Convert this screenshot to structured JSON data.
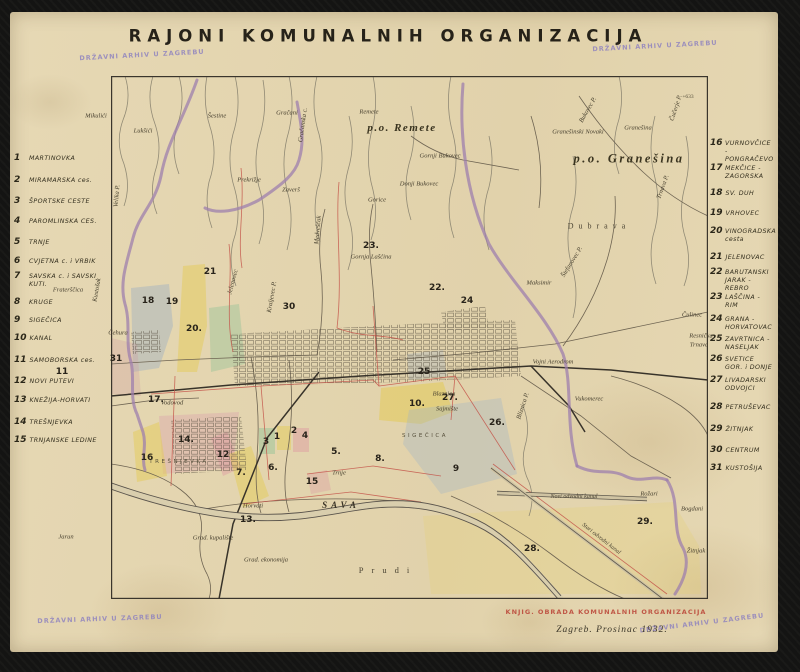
{
  "palette": {
    "paper": "#e6d8b4",
    "ink": "#2b2719",
    "purple_boundary": "#9d7fae",
    "red_boundary": "#c4554a",
    "stamp_purple": "#8b7fc0",
    "stamp_red": "#b8392e",
    "river": "#5a544c",
    "yellow_district": "#e4cb58",
    "green_district": "#98c498",
    "blue_district": "#94aac4",
    "rose_district": "#da a2ac"
  },
  "title": "RAJONI KOMUNALNIH ORGANIZACIJA",
  "stamp_text": "DRŽAVNI ARHIV U ZAGREBU",
  "footer": {
    "red_stamp": "KNJIG. OBRADA KOMUNALNIH ORGANIZACIJA",
    "date": "Zagreb. Prosinac 1932."
  },
  "left_list": [
    {
      "num": "1",
      "label": "MARTINOVKA",
      "y": 158
    },
    {
      "num": "2",
      "label": "MIRAMARSKA ces.",
      "y": 180
    },
    {
      "num": "3",
      "label": "ŠPORTSKE CESTE",
      "y": 201
    },
    {
      "num": "4",
      "label": "PAROMLINSKA CES.",
      "y": 221
    },
    {
      "num": "5",
      "label": "TRNJE",
      "y": 242
    },
    {
      "num": "6",
      "label": "CVJETNA c. i VRBIK",
      "y": 261
    },
    {
      "num": "7",
      "label": "SAVSKA c. i SAVSKI KUTI.",
      "y": 280
    },
    {
      "num": "8",
      "label": "KRUGE",
      "y": 302
    },
    {
      "num": "9",
      "label": "SIGEČICA",
      "y": 320
    },
    {
      "num": "10",
      "label": "KANAL",
      "y": 338
    },
    {
      "num": "11",
      "label": "SAMOBORSKA ces.",
      "y": 360
    },
    {
      "num": "12",
      "label": "NOVI PUTEVI",
      "y": 381
    },
    {
      "num": "13",
      "label": "KNEŽIJA-HORVATI",
      "y": 400
    },
    {
      "num": "14",
      "label": "TREŠNJEVKA",
      "y": 422
    },
    {
      "num": "15",
      "label": "TRNJANSKE LEDINE",
      "y": 440
    }
  ],
  "right_list": [
    {
      "num": "16",
      "label": "VURNOVČICE - PONGRAČEVO",
      "y": 151
    },
    {
      "num": "17",
      "label": "MEKČICE - ZAGORSKA",
      "y": 172
    },
    {
      "num": "18",
      "label": "SV. DUH",
      "y": 193
    },
    {
      "num": "19",
      "label": "VRHOVEC",
      "y": 213
    },
    {
      "num": "20",
      "label": "VINOGRADSKA cesta",
      "y": 235
    },
    {
      "num": "21",
      "label": "JELENOVAC",
      "y": 257
    },
    {
      "num": "22",
      "label": "BARUTANSKI JARAK - REBRO",
      "y": 280
    },
    {
      "num": "23",
      "label": "LAŠČINA - RIM",
      "y": 301
    },
    {
      "num": "24",
      "label": "GRANA - HORVATOVAC",
      "y": 323
    },
    {
      "num": "25",
      "label": "ZAVRTNICA - NASELJAK",
      "y": 343
    },
    {
      "num": "26",
      "label": "SVETICE GOR. i DONJE",
      "y": 363
    },
    {
      "num": "27",
      "label": "LIVADARSKI ODVOJCI",
      "y": 384
    },
    {
      "num": "28",
      "label": "PETRUŠEVAC",
      "y": 407
    },
    {
      "num": "29",
      "label": "ŽITNJAK",
      "y": 429
    },
    {
      "num": "30",
      "label": "CENTRUM",
      "y": 450
    },
    {
      "num": "31",
      "label": "KUSTOŠIJA",
      "y": 468
    }
  ],
  "map": {
    "labels": [
      {
        "t": "Mikulići",
        "x": 96,
        "y": 116
      },
      {
        "t": "Lukšići",
        "x": 143,
        "y": 131
      },
      {
        "t": "Šestine",
        "x": 217,
        "y": 116
      },
      {
        "t": "Gračani",
        "x": 287,
        "y": 113
      },
      {
        "t": "Remete",
        "x": 369,
        "y": 112
      },
      {
        "t": "p.o. Remete",
        "x": 402,
        "y": 128,
        "cls": "big"
      },
      {
        "t": "Gornji Bukovec",
        "x": 440,
        "y": 156
      },
      {
        "t": "Donji Bukovec",
        "x": 419,
        "y": 184
      },
      {
        "t": "Granešinski Novaki",
        "x": 578,
        "y": 132
      },
      {
        "t": "Granešina",
        "x": 638,
        "y": 128
      },
      {
        "t": "p.o. Granešina",
        "x": 629,
        "y": 159,
        "cls": "big2"
      },
      {
        "t": "Dubrava",
        "x": 599,
        "y": 226,
        "cls": "sp"
      },
      {
        "t": "Prekrižje",
        "x": 249,
        "y": 180
      },
      {
        "t": "Zaverš",
        "x": 291,
        "y": 190
      },
      {
        "t": "Gorice",
        "x": 377,
        "y": 200
      },
      {
        "t": "Gornja Lašćina",
        "x": 371,
        "y": 257
      },
      {
        "t": "Maksimir",
        "x": 539,
        "y": 283
      },
      {
        "t": "Vojni Aerodrom",
        "x": 553,
        "y": 362
      },
      {
        "t": "Vukomerec",
        "x": 589,
        "y": 399
      },
      {
        "t": "Čulinec",
        "x": 692,
        "y": 315
      },
      {
        "t": "Resnička",
        "x": 701,
        "y": 336
      },
      {
        "t": "Trnava",
        "x": 699,
        "y": 345
      },
      {
        "t": "Fraterščica",
        "x": 68,
        "y": 290
      },
      {
        "t": "Čehura",
        "x": 118,
        "y": 333
      },
      {
        "t": "Horvati",
        "x": 253,
        "y": 506
      },
      {
        "t": "Jarun",
        "x": 66,
        "y": 537
      },
      {
        "t": "Grad. kupalište",
        "x": 213,
        "y": 538
      },
      {
        "t": "Grad. ekonomija",
        "x": 266,
        "y": 560
      },
      {
        "t": "Rožari",
        "x": 649,
        "y": 494
      },
      {
        "t": "Bogdani",
        "x": 692,
        "y": 509
      },
      {
        "t": "Žitnjak",
        "x": 696,
        "y": 551
      },
      {
        "t": "Blaznica",
        "x": 444,
        "y": 394
      },
      {
        "t": "Sajmište",
        "x": 447,
        "y": 409
      },
      {
        "t": "Trnje",
        "x": 339,
        "y": 473
      },
      {
        "t": "Vodovod",
        "x": 172,
        "y": 403
      },
      {
        "t": "Novi odvodni kanal",
        "x": 574,
        "y": 497,
        "cls": "si"
      },
      {
        "t": "Stari odvodni kanal",
        "x": 601,
        "y": 539,
        "r": 38,
        "cls": "si"
      },
      {
        "t": "Velika P.",
        "x": 117,
        "y": 196,
        "r": -85
      },
      {
        "t": "Kustošak",
        "x": 97,
        "y": 290,
        "r": -80
      },
      {
        "t": "Jelenovec",
        "x": 233,
        "y": 282,
        "r": -75
      },
      {
        "t": "Kraljevec P.",
        "x": 272,
        "y": 297,
        "r": -80
      },
      {
        "t": "Medveščak",
        "x": 318,
        "y": 230,
        "r": -85
      },
      {
        "t": "Gračanska c.",
        "x": 303,
        "y": 125,
        "r": -82
      },
      {
        "t": "Bliznica P.",
        "x": 523,
        "y": 406,
        "r": -72
      },
      {
        "t": "Štefanovec P.",
        "x": 572,
        "y": 262,
        "r": -58
      },
      {
        "t": "Trnava P.",
        "x": 663,
        "y": 187,
        "r": -70
      },
      {
        "t": "Bukovec P.",
        "x": 588,
        "y": 110,
        "r": -60
      },
      {
        "t": "Čučerje P.",
        "x": 676,
        "y": 108,
        "r": -72
      },
      {
        "t": "TREŠNJEVKA",
        "x": 179,
        "y": 462,
        "cls": "spx"
      },
      {
        "t": "SIGEČICA",
        "x": 425,
        "y": 436,
        "cls": "spx"
      },
      {
        "t": "SAVA",
        "x": 341,
        "y": 505,
        "cls": "sava"
      },
      {
        "t": "Prudi",
        "x": 388,
        "y": 570,
        "cls": "sp2"
      },
      {
        "t": "+633",
        "x": 688,
        "y": 97,
        "cls": "tiny"
      }
    ],
    "numbers": [
      {
        "n": "1",
        "x": 277,
        "y": 437
      },
      {
        "n": "2",
        "x": 294,
        "y": 431
      },
      {
        "n": "3",
        "x": 266,
        "y": 442
      },
      {
        "n": "4",
        "x": 305,
        "y": 436
      },
      {
        "n": "5.",
        "x": 336,
        "y": 452
      },
      {
        "n": "6.",
        "x": 273,
        "y": 468
      },
      {
        "n": "7.",
        "x": 241,
        "y": 473
      },
      {
        "n": "8.",
        "x": 380,
        "y": 459
      },
      {
        "n": "9",
        "x": 456,
        "y": 469
      },
      {
        "n": "10.",
        "x": 417,
        "y": 404
      },
      {
        "n": "11",
        "x": 62,
        "y": 372
      },
      {
        "n": "12",
        "x": 223,
        "y": 455
      },
      {
        "n": "13.",
        "x": 248,
        "y": 520
      },
      {
        "n": "14.",
        "x": 186,
        "y": 440
      },
      {
        "n": "15",
        "x": 312,
        "y": 482
      },
      {
        "n": "16",
        "x": 147,
        "y": 458
      },
      {
        "n": "17.",
        "x": 156,
        "y": 400
      },
      {
        "n": "18",
        "x": 148,
        "y": 301
      },
      {
        "n": "19",
        "x": 172,
        "y": 302
      },
      {
        "n": "20.",
        "x": 194,
        "y": 329
      },
      {
        "n": "21",
        "x": 210,
        "y": 272
      },
      {
        "n": "22.",
        "x": 437,
        "y": 288
      },
      {
        "n": "23.",
        "x": 371,
        "y": 246
      },
      {
        "n": "24",
        "x": 467,
        "y": 301
      },
      {
        "n": "25",
        "x": 424,
        "y": 372
      },
      {
        "n": "26.",
        "x": 497,
        "y": 423
      },
      {
        "n": "27.",
        "x": 450,
        "y": 398
      },
      {
        "n": "28.",
        "x": 532,
        "y": 549
      },
      {
        "n": "29.",
        "x": 645,
        "y": 522
      },
      {
        "n": "30",
        "x": 289,
        "y": 307
      },
      {
        "n": "31",
        "x": 116,
        "y": 359
      }
    ]
  }
}
